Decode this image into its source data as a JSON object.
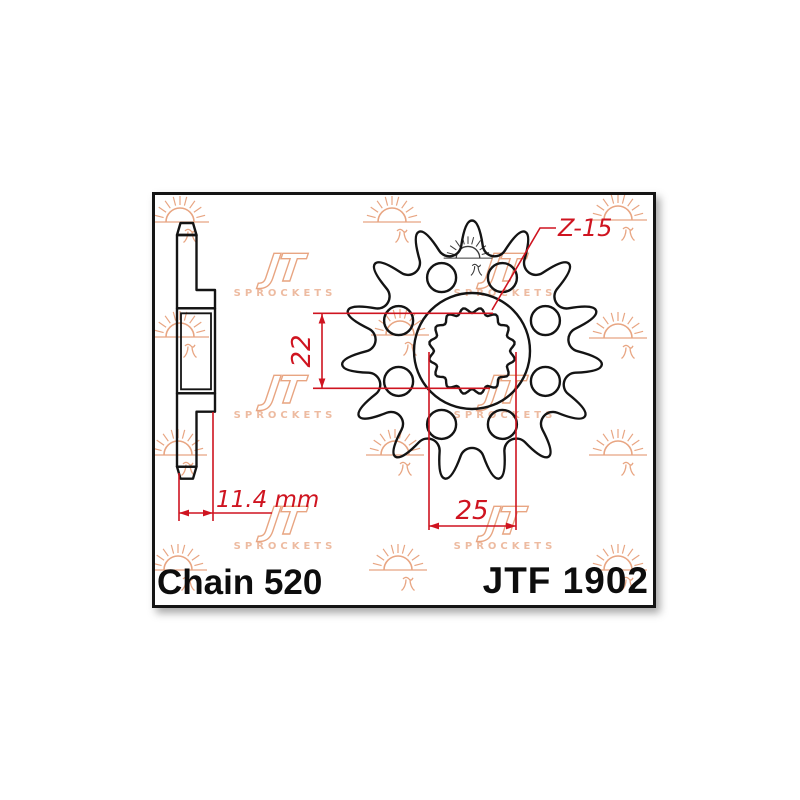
{
  "drawing": {
    "chain_label": "Chain 520",
    "model_label": "JTF 1902"
  },
  "dimensions": {
    "bore_diameter": "22",
    "spline_outer_diameter": "25",
    "hub_width": "11.4 mm",
    "teeth_count": "Z-15"
  },
  "watermark": {
    "monogram": "JT",
    "sprockets_label": "SPROCKETS"
  },
  "colors": {
    "dimension_red": "#cf1420",
    "line_black": "#141414",
    "watermark_peach": "#e8a582"
  }
}
